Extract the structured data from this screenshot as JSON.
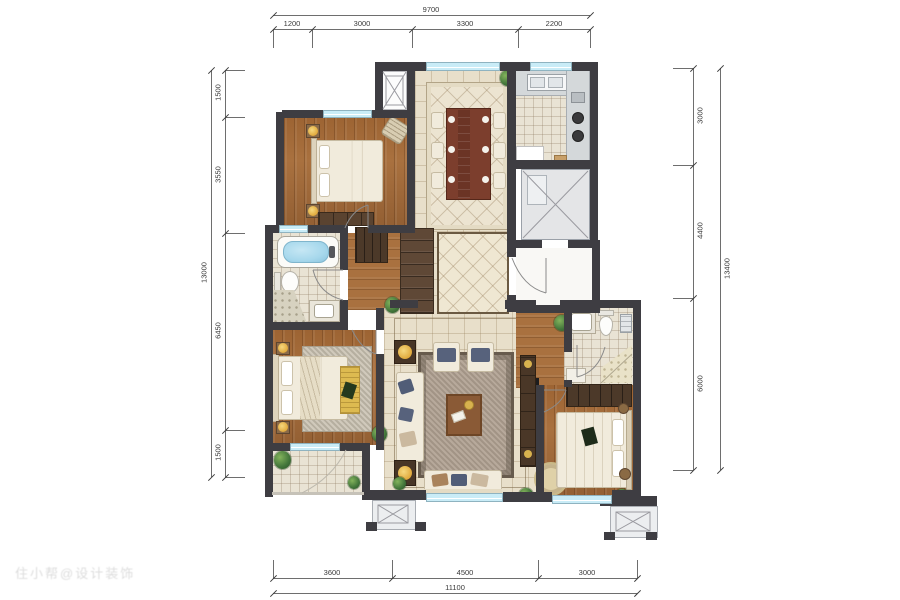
{
  "watermark": "住小帮@设计装饰",
  "dimensions": {
    "top": {
      "total": "9700",
      "segments": [
        "1200",
        "3000",
        "3300",
        "2200"
      ]
    },
    "bottom": {
      "total": "11100",
      "segments": [
        "3600",
        "4500",
        "3000"
      ]
    },
    "left": {
      "total": "13000",
      "segments": [
        "1500",
        "3550",
        "6450",
        "1500"
      ]
    },
    "right": {
      "total": "13400",
      "segments": [
        "3000",
        "4400",
        "6000"
      ]
    }
  },
  "colors": {
    "wall": "#3e3d42",
    "window": "#c9ecf7",
    "wood_floor": "#a9713f",
    "tile_floor": "#e8dfca",
    "accent_gold": "#e0bb54",
    "water_blue": "#a7d8ec"
  }
}
